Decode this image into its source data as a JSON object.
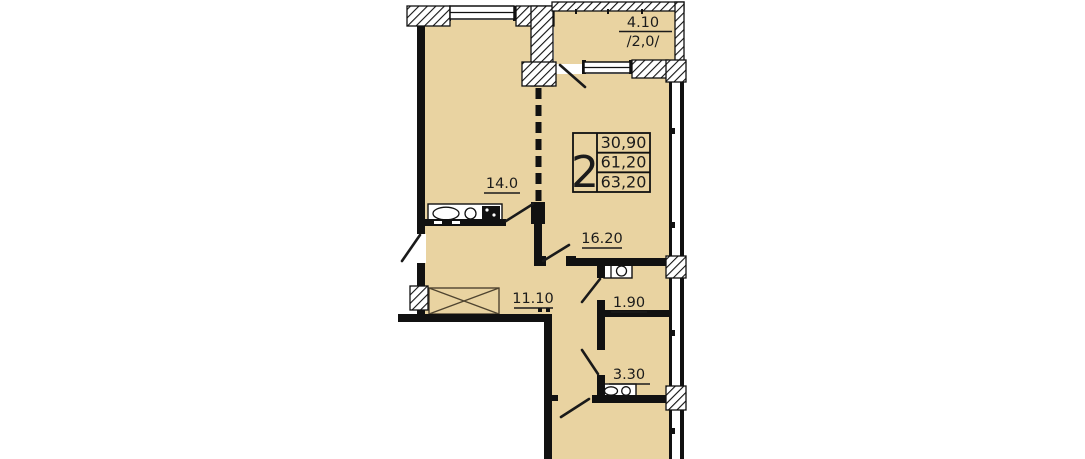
{
  "floor_plan": {
    "apartment_table": {
      "rooms_count": "2",
      "living_area": "30,90",
      "floor_area": "61,20",
      "total_area": "63,20"
    },
    "rooms": {
      "kitchen_living": {
        "label": "14.0"
      },
      "bedroom": {
        "label": "16.20"
      },
      "hallway": {
        "label": "11.10"
      },
      "wc": {
        "label": "1.90"
      },
      "bathroom": {
        "label": "3.30"
      },
      "balcony": {
        "label": "4.10",
        "reduced": "/2,0/"
      }
    },
    "colors": {
      "floor": "#e9d3a1",
      "wall": "#111111",
      "text": "#1b1b1b",
      "background": "#ffffff"
    }
  }
}
